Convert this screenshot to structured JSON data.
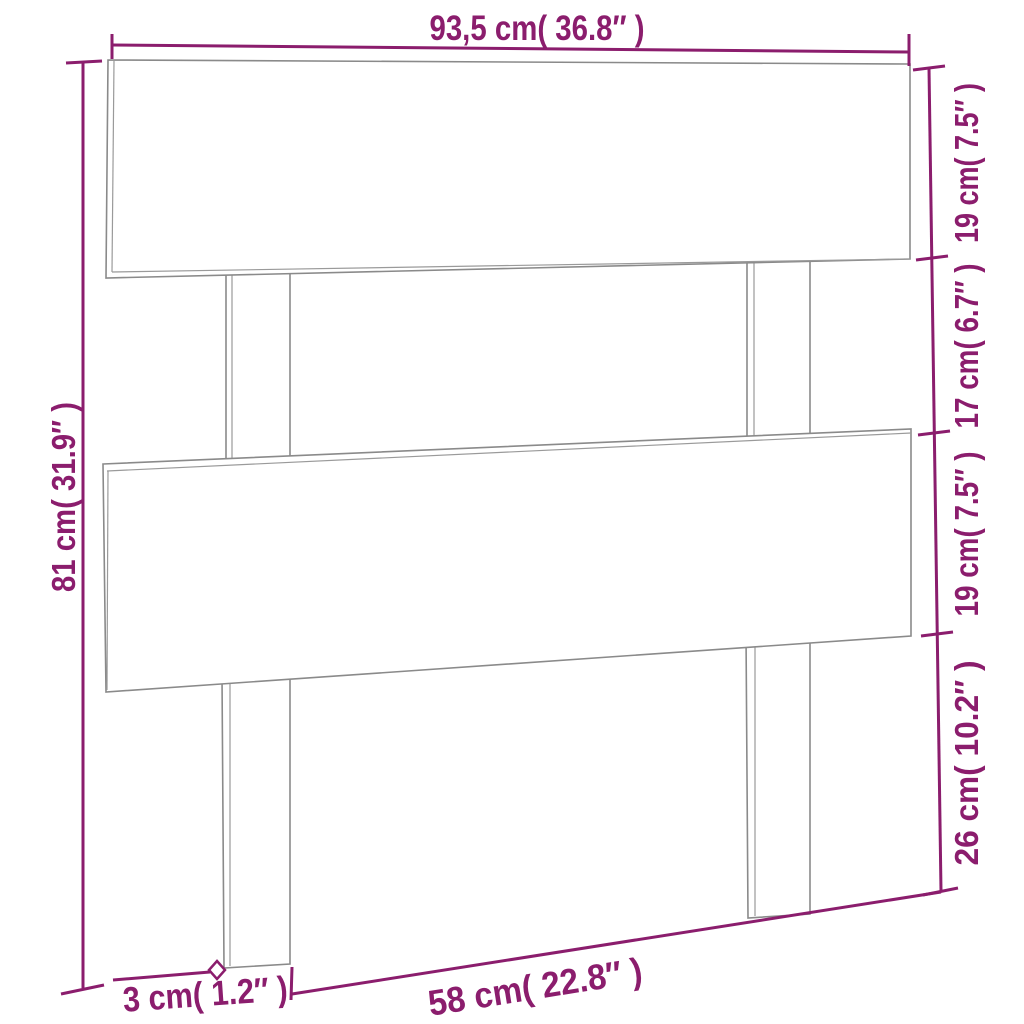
{
  "diagram": {
    "colors": {
      "dimension": "#8b1d6d",
      "outline": "#8a8a8a",
      "background": "#ffffff"
    },
    "dimensions": {
      "width_top": "93,5 cm( 36.8″ )",
      "height_left": "81 cm( 31.9″ )",
      "right_segments": [
        {
          "label": "19 cm( 7.5″ )"
        },
        {
          "label": "17 cm( 6.7″ )"
        },
        {
          "label": "19 cm( 7.5″ )"
        },
        {
          "label": "26 cm( 10.2″ )"
        }
      ],
      "bottom_thickness": "3 cm( 1.2″ )",
      "bottom_span": "58 cm( 22.8″ )"
    }
  }
}
